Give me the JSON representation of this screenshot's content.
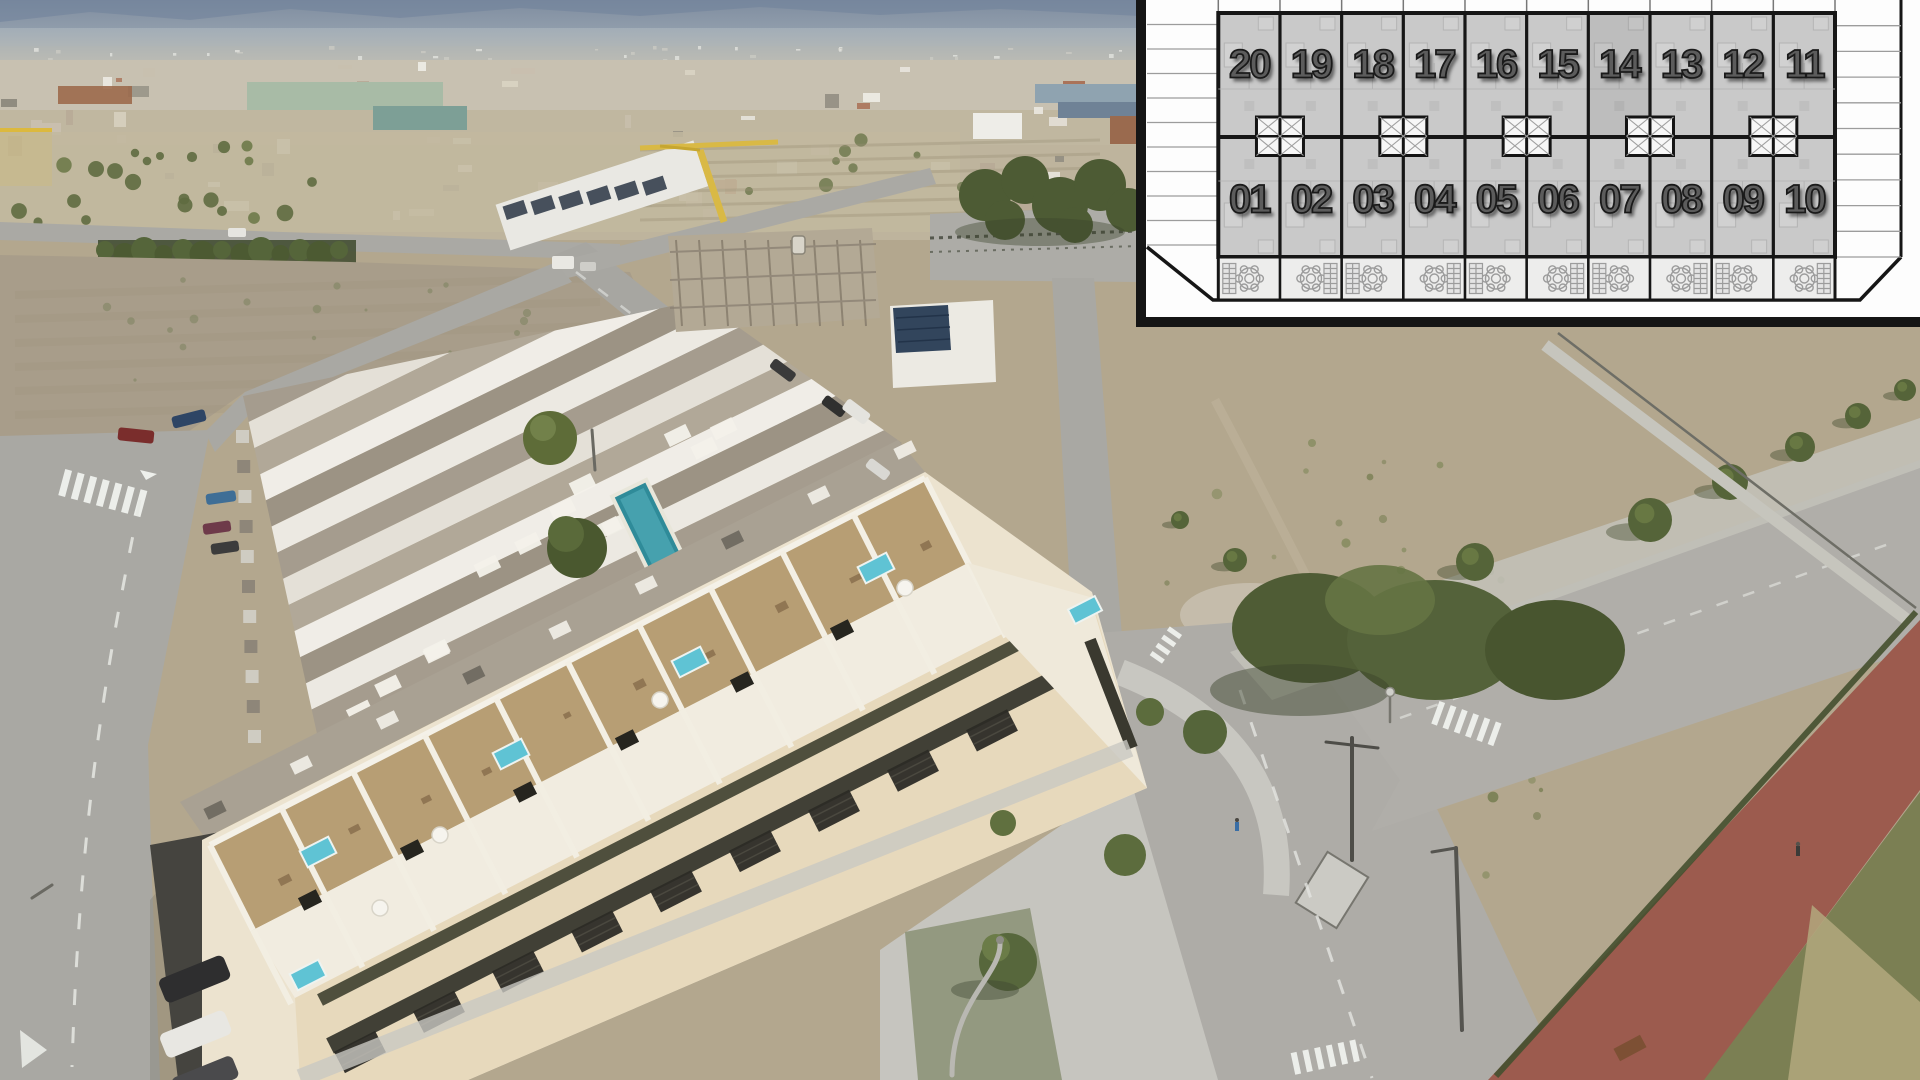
{
  "overlay": {
    "top_row": [
      "20",
      "19",
      "18",
      "17",
      "16",
      "15",
      "14",
      "13",
      "12",
      "11"
    ],
    "bottom_row": [
      "01",
      "02",
      "03",
      "04",
      "05",
      "06",
      "07",
      "08",
      "09",
      "10"
    ]
  },
  "palette": {
    "plan_bg": "#fdfdfd",
    "plan_border_black": "#151515",
    "plan_unit_fill": "#c9c9c9",
    "plan_line": "#161616",
    "plan_detail_gray": "#9c9c9c",
    "plan_terrace_fill": "#ededec",
    "plan_number_gray": "#5c5c5c",
    "road_gray": "#a9a8a3",
    "dirt_tan": "#b3a78e",
    "scrub_green": "#6d7748",
    "tree_green": "#52613a",
    "bike_path_red": "#9c5b4e",
    "grass_verge": "#7b7f53",
    "building_cream": "#ece3cf",
    "deck_tan": "#b79e74",
    "communal_pool_teal": "#2f8b99",
    "rooftop_pool_cyan": "#5fc3d4",
    "crane_yellow": "#d9b945",
    "mountain_haze": "#8a97a6",
    "church_yellow": "#dcb93e",
    "sports_field_green": "#a8bba6"
  }
}
